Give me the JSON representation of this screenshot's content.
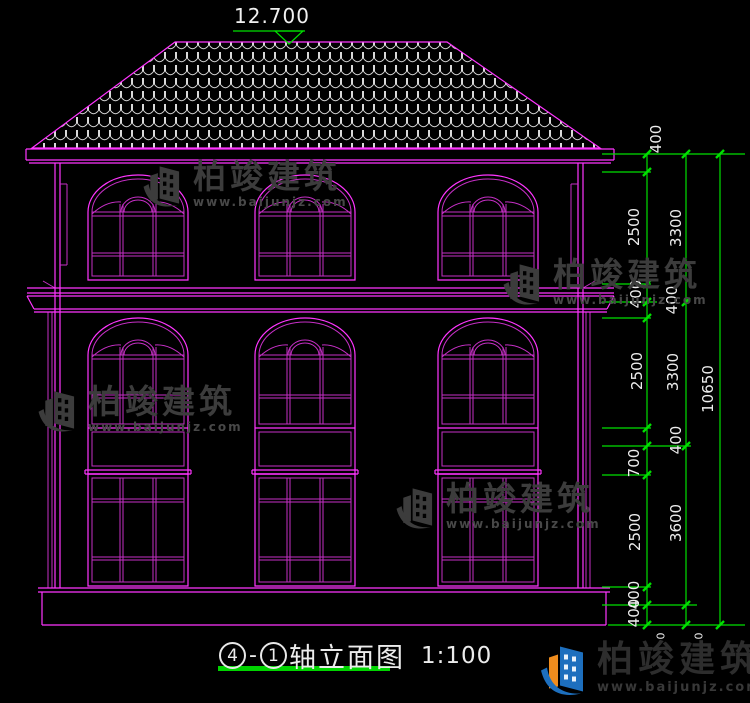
{
  "drawing": {
    "level_annotation": "12.700",
    "title": {
      "axis_from": "4",
      "axis_sep": "-",
      "axis_to": "1",
      "name": "轴立面图",
      "scale": "1:100"
    }
  },
  "dims": {
    "chain1": [
      "400",
      "2500",
      "400",
      "400",
      "2500",
      "400",
      "700",
      "2500",
      "400",
      "400"
    ],
    "chain2": [
      "3300",
      "3300",
      "3600"
    ],
    "chain3": [
      "10650"
    ],
    "zeros": [
      "0",
      "0"
    ]
  },
  "watermark": {
    "brand": "柏竣建筑",
    "url": "www.baijunjz.com"
  },
  "logo": {
    "brand": "柏竣建筑",
    "url": "www.baijunjz.com"
  },
  "colors": {
    "background": "#000000",
    "line_primary": "#ff35ff",
    "line_secondary": "#c62fc6",
    "dimension_green": "#00df00",
    "text_white": "#f0f0f0",
    "roof_tile": "#d9d9d9",
    "watermark_gray": "#3c3c3c",
    "logo_blue": "#1d6fbe",
    "logo_orange": "#ef8c1d"
  }
}
